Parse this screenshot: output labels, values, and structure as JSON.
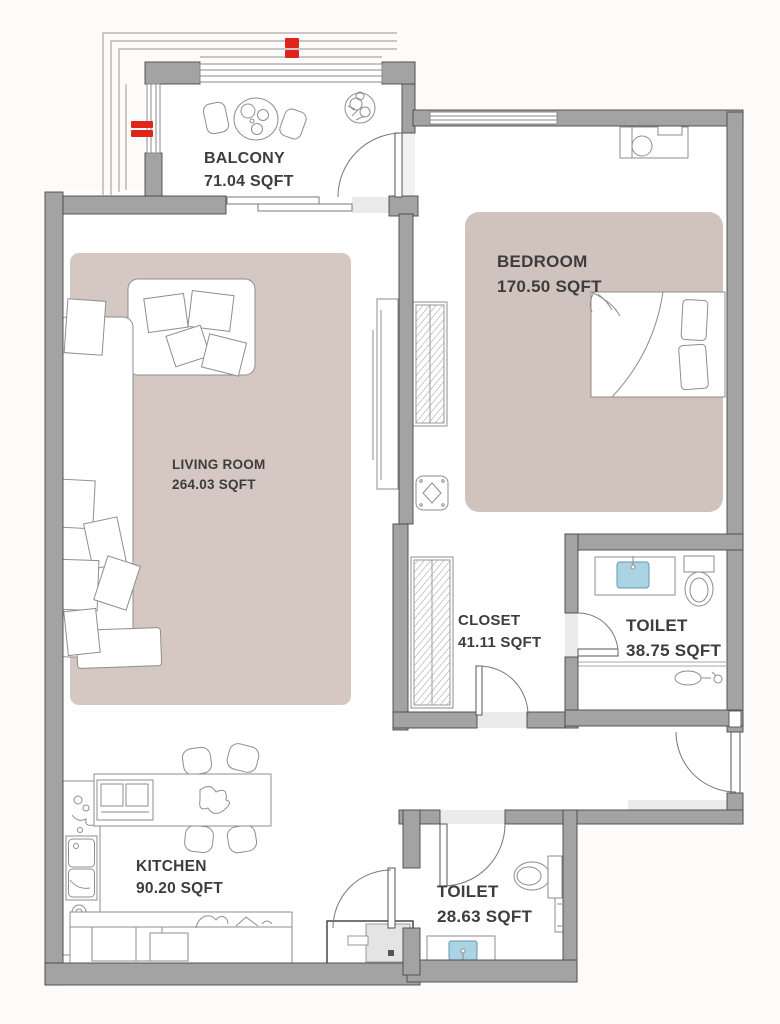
{
  "plan_type": "apartment-floor-plan",
  "rooms": [
    {
      "id": "balcony",
      "label": "BALCONY",
      "area": "71.04 SQFT"
    },
    {
      "id": "bedroom",
      "label": "BEDROOM",
      "area": "170.50 SQFT"
    },
    {
      "id": "living_room",
      "label": "LIVING ROOM",
      "area": "264.03 SQFT"
    },
    {
      "id": "closet",
      "label": "CLOSET",
      "area": "41.11 SQFT"
    },
    {
      "id": "toilet_main",
      "label": "TOILET",
      "area": "38.75 SQFT"
    },
    {
      "id": "kitchen",
      "label": "KITCHEN",
      "area": "90.20 SQFT"
    },
    {
      "id": "toilet_guest",
      "label": "TOILET",
      "area": "28.63 SQFT"
    }
  ],
  "colors": {
    "wall_fill": "#a3a3a3",
    "wall_edge": "#474747",
    "living_rug": "#d5c7c1",
    "bedroom_rug": "#d0c2bc",
    "sink_blue": "#abd3e6",
    "marker_red": "#e02419",
    "label_text": "#3d3d3d",
    "sketch_stroke": "#8e8e8e"
  }
}
